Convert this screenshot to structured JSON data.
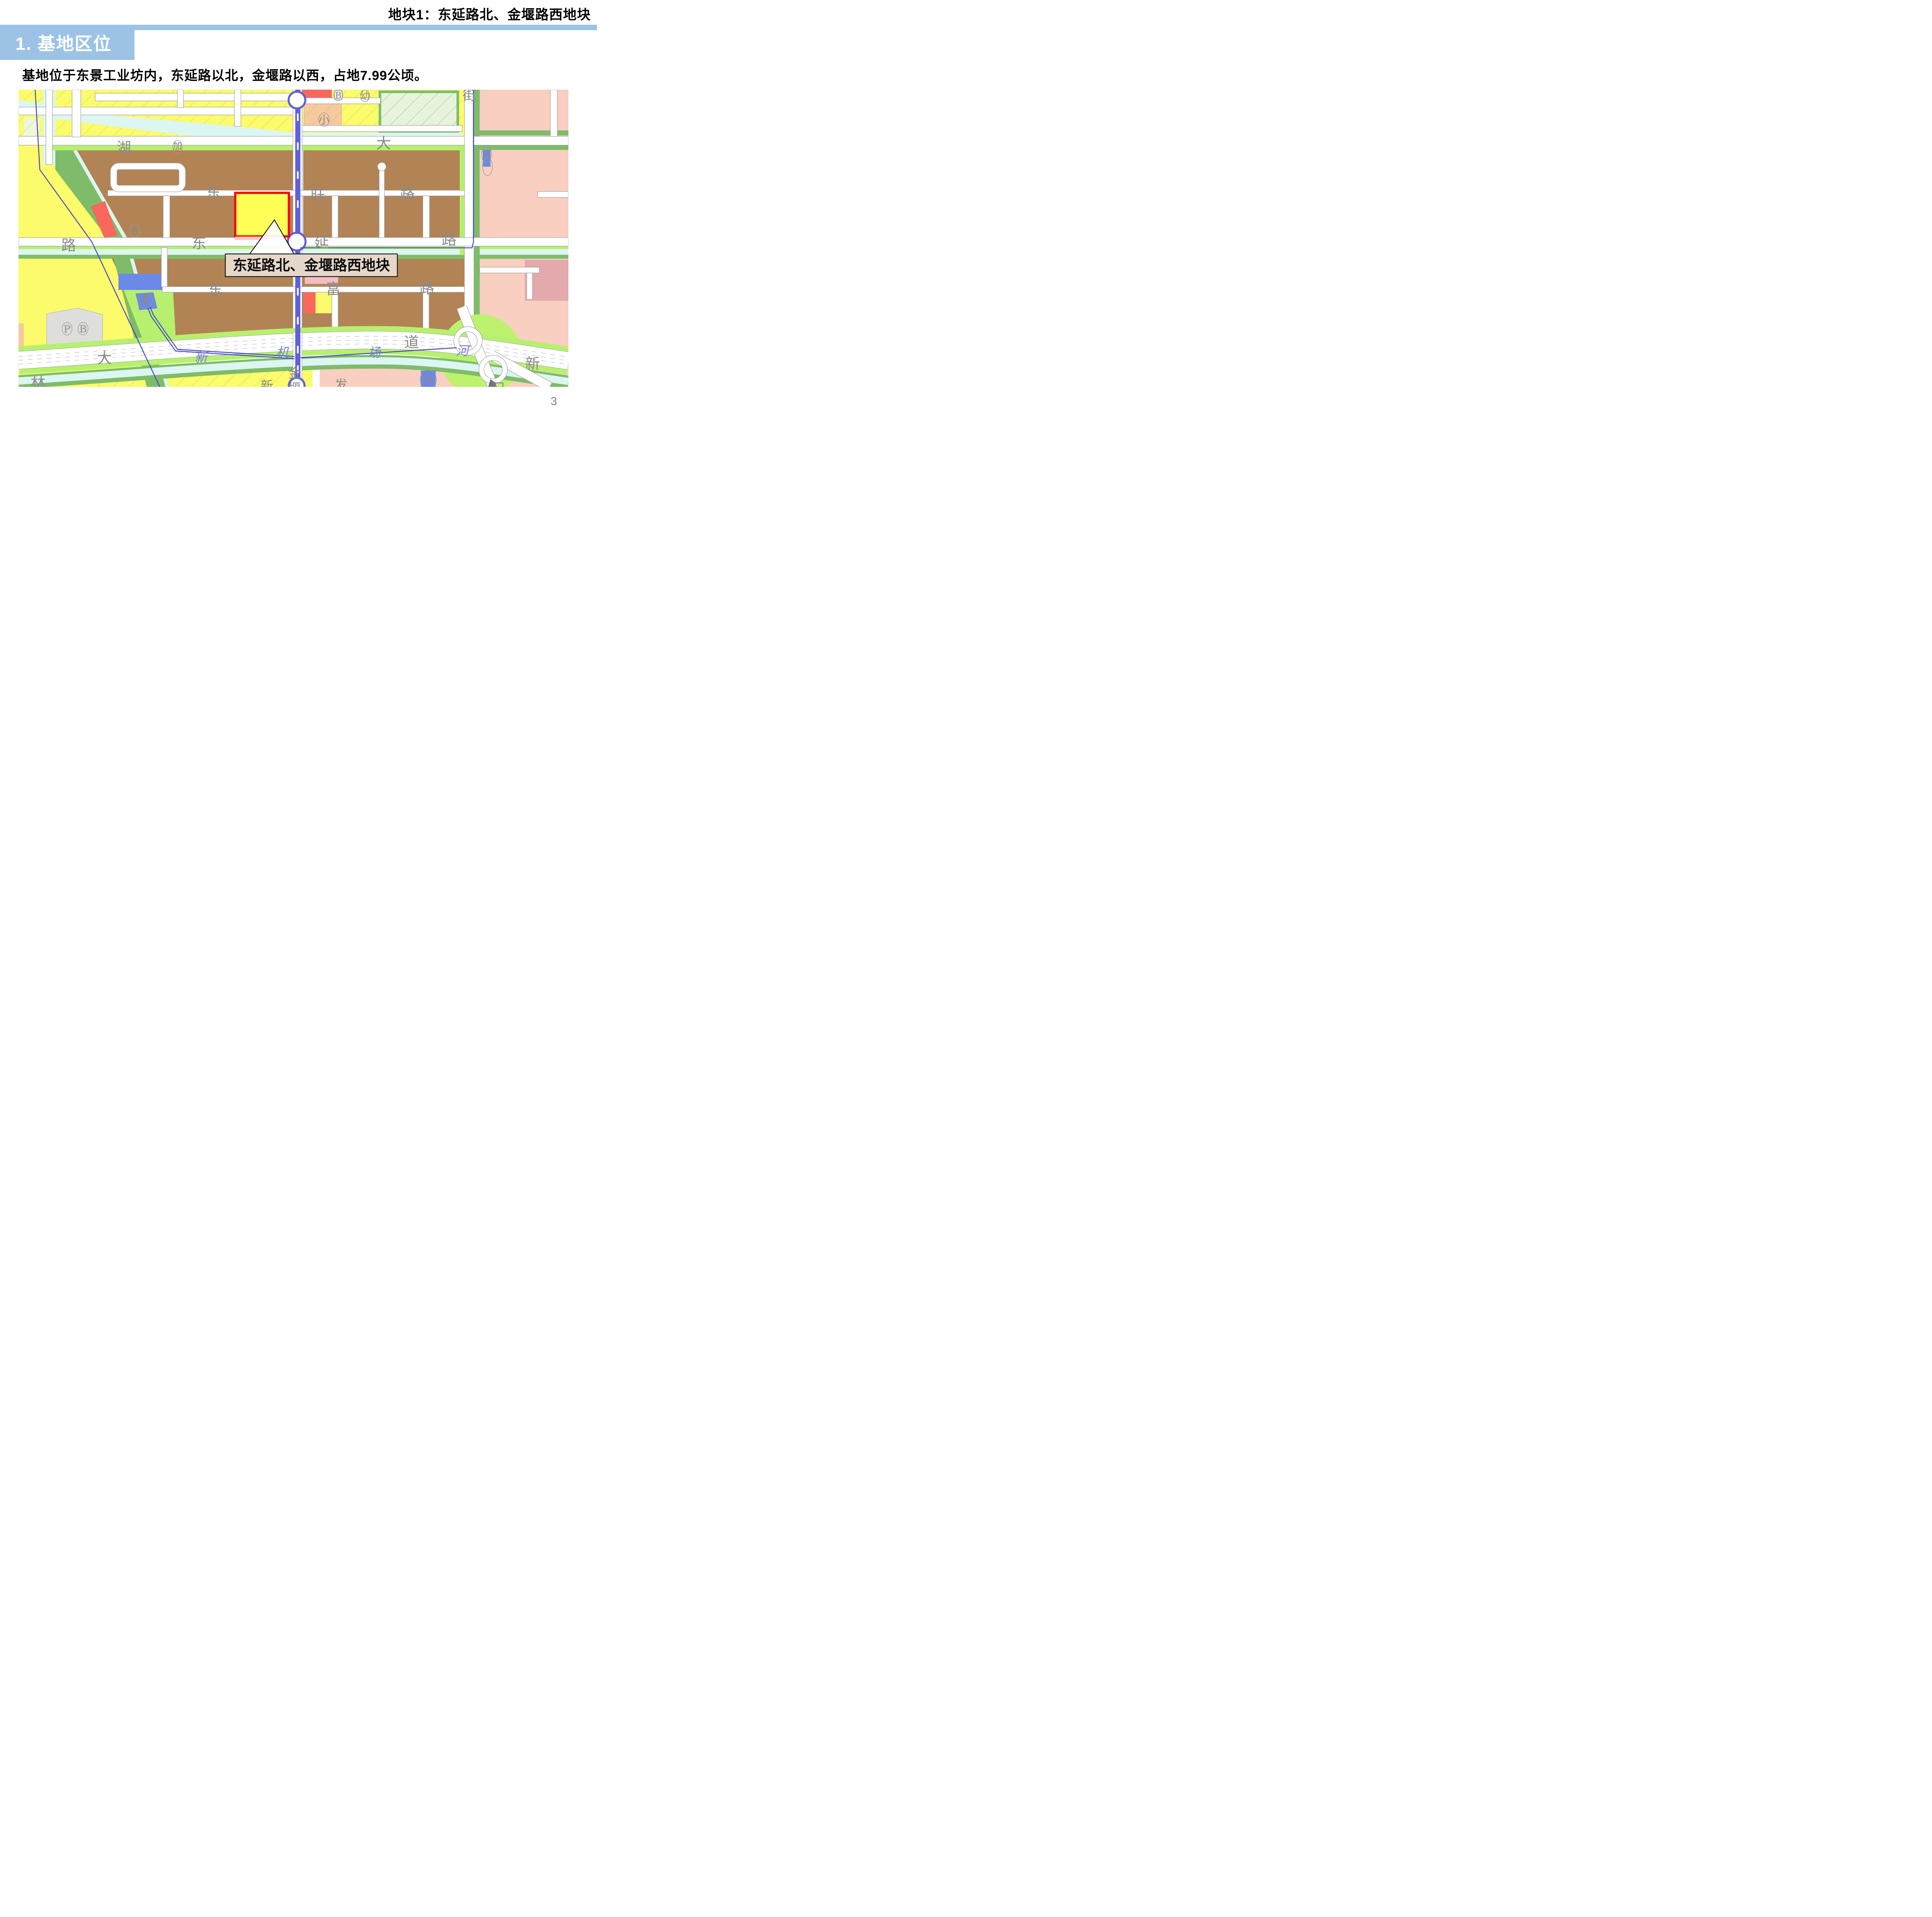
{
  "page": {
    "number": "3"
  },
  "header": {
    "tag": "地块1：东延路北、金堰路西地块",
    "section_title": "1. 基地区位"
  },
  "body": {
    "description": "基地位于东景工业坊内，东延路以北，金堰路以西，占地7.99公顷。"
  },
  "map": {
    "callout": {
      "label": "东延路北、金堰路西地块"
    },
    "site": {
      "area_hectares": "7.99",
      "outline_color": "#FF0000",
      "fill_color": "#FFFF58"
    },
    "labels": {
      "lake": "湖",
      "gas": "加",
      "biz_top": "B",
      "kindergarten": "幼",
      "primary_school": "小",
      "street": "街",
      "boulevard_da": "大",
      "sewage": "污",
      "dw_dong": "东",
      "dw_wang": "旺",
      "dw_lu": "路",
      "dy_dong": "东",
      "dy_yan": "延",
      "dy_lu": "路",
      "df_dong": "东",
      "df_fu": "富",
      "df_lu": "路",
      "biz_mid": "B",
      "parking_p": "P",
      "parking_b": "B",
      "ave_da": "大",
      "ave_dao": "道",
      "jin": "金",
      "yan_cut": "堰",
      "lin": "林",
      "xin_cut": "新",
      "fa": "发",
      "xin_right": "新",
      "telecom": "信",
      "dian_cut": "电",
      "ri_cut": "日",
      "lu_diagonal": "路",
      "river_xin": "新",
      "river_ji": "机",
      "river_chang": "场",
      "river_he": "河"
    },
    "colors": {
      "header_band": "#9CC3E6",
      "industrial_brown": "#B28455",
      "residential_yellow": "#FBFB6B",
      "residential_salmon": "#F8CFC0",
      "green_buffer": "#7FBC69",
      "green_bright": "#B7F06F",
      "water_cyan": "#DCF6F2",
      "metro_blue": "#6060D8",
      "boundary_blue": "#4646C8",
      "school_peach": "#F7CA9E",
      "utility_blue": "#6C88E8",
      "commercial_red": "#FA675C",
      "plot_fill": "#FFFF58",
      "plot_outline": "#FF0000",
      "callout_bg": "#E5D7C9"
    }
  }
}
